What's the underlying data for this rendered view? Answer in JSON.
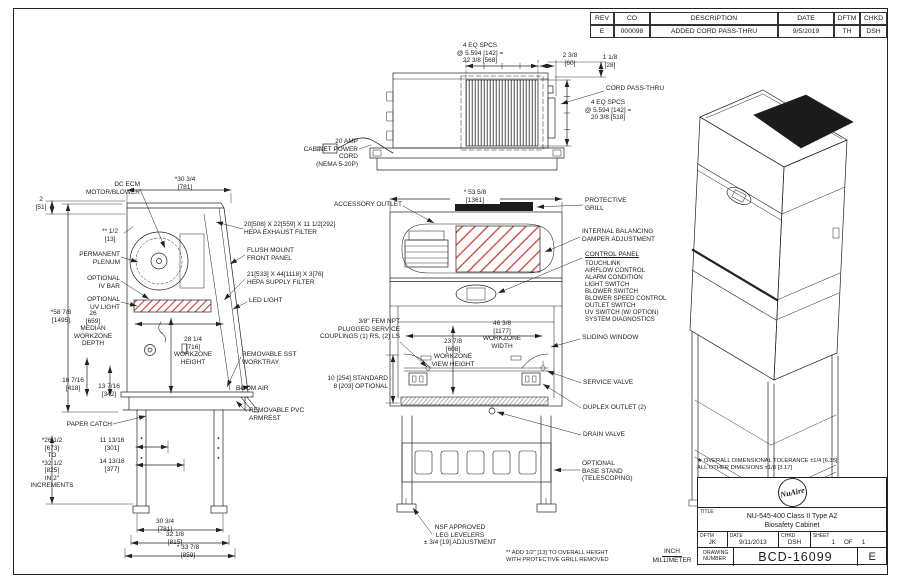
{
  "sheet": {
    "units_primary": "INCH",
    "units_secondary": "MILLIMETER",
    "tolerance_note": "★ OVERALL DIMENSIONAL TOLERANCE ±1/4 [6.35]\nALL OTHER DIMESIONS ±1/8 [3.17]",
    "footnote": "** ADD 1/2\" [13] TO OVERALL HEIGHT\nWITH PROTECTIVE GRILL REMOVED"
  },
  "revision_table": {
    "headers": [
      "REV",
      "CO",
      "DESCRIPTION",
      "DATE",
      "DFTM",
      "CHKD"
    ],
    "rows": [
      [
        "E",
        "000098",
        "ADDED CORD PASS-THRU",
        "9/5/2019",
        "TH",
        "DSH"
      ]
    ]
  },
  "title_block": {
    "logo": "NuAire",
    "title_label": "TITLE",
    "title": "NU-545-400 Class II Type A2\nBiosafety Cabinet",
    "dftm_label": "DFTM",
    "dftm": "JK",
    "date_label": "DATE",
    "date": "9/11/2013",
    "chkd_label": "CHKD",
    "chkd": "DSH",
    "sheet_label": "SHEET",
    "sheet_num": "1",
    "of_label": "OF",
    "sheet_total": "1",
    "drawing_number_label": "DRAWING\nNUMBER",
    "drawing_number": "BCD-16099",
    "revision": "E"
  },
  "colors": {
    "line": "#222222",
    "hatch_red": "#c94036",
    "grille_dark": "#1b1b1b"
  },
  "labels": {
    "dc_ecm": "DC ECM\nMOTOR/BLOWER",
    "dim_2": "2\n[51]",
    "dim_30_34_top": "*30 3/4\n[781]",
    "dim_half": "** 1/2\n[13]",
    "permanent_plenum": "PERMANENT\nPLENUM",
    "optional_iv_bar": "OPTIONAL\nIV BAR",
    "optional_uv_light": "OPTIONAL\nUV LIGHT",
    "dim_58_78": "*58 7/8\n[1495]",
    "median_workzone": "26\n[659]\nMEDIAN\nWORKZONE\nDEPTH",
    "workzone_height": "28 1/4\n[716]\nWORKZONE\nHEIGHT",
    "dim_16_716": "16 7/16\n[418]",
    "dim_13_716": "13 7/16\n[342]",
    "paper_catch": "PAPER CATCH",
    "stand_range": "*26 1/2\n[673]\nTO\n*32 1/2\n[825]\nIN 2\"\nINCREMENTS",
    "dim_11_1316": "11 13/16\n[301]",
    "dim_14_1316": "14 13/16\n[377]",
    "dim_30_34_bot": "30 3/4\n[781]",
    "dim_32_18": "32 1/8\n[815]",
    "dim_33_78": "* 33 7/8\n[859]",
    "hepa_exhaust": "20[508] X 22[559] X 11 1/2[292]\nHEPA EXHAUST FILTER",
    "flush_mount": "FLUSH MOUNT\nFRONT PANEL",
    "hepa_supply": "21[533] X 44[1118] X 3[76]\nHEPA SUPPLY FILTER",
    "led_light": "LED LIGHT",
    "service_couplings": "3/8\" FEM NPT\nPLUGGED SERVICE\nCOUPLINGS (1) RS, (2) LS",
    "removable_sst": "REMOVABLE SST\nWORKTRAY",
    "room_air": "ROOM AIR",
    "removable_pvc": "REMOVABLE PVC\nARMREST",
    "worktray_height": "10 [254] STANDARD\n8 [203] OPTIONAL",
    "eq_spcs_top": "4 EQ SPCS\n@ 5.594 [142] =\n22 3/8 [568]",
    "dim_2_38": "2 3/8\n[60]",
    "dim_1_18": "1 1/8\n[28]",
    "cord_pass_thru": "CORD PASS-THRU",
    "eq_spcs_side": "4 EQ SPCS\n@ 5.594 [142] =\n20 3/8 [518]",
    "power_cord": "20 AMP\nCABINET POWER CORD\n(NEMA 5-20P)",
    "accessory_outlet": "ACCESSORY OUTLET",
    "dim_53_58": "* 53 5/8\n[1361]",
    "protective_grill": "PROTECTIVE\nGRILL",
    "internal_balancing": "INTERNAL BALANCING\nDAMPER ADJUSTMENT",
    "control_panel_title": "CONTROL PANEL",
    "control_panel_items": [
      "TOUCHLINK",
      "AIRFLOW CONTROL",
      "ALARM CONDITION",
      "LIGHT SWITCH",
      "BLOWER SWITCH",
      "BLOWER SPEED CONTROL",
      "OUTLET SWITCH",
      "UV SWITCH (W/ OPTION)",
      "SYSTEM DIAGNOSTICS"
    ],
    "sliding_window": "SLIDING WINDOW",
    "workzone_width": "46 3/8\n[1177]\nWORKZONE\nWIDTH",
    "workzone_view_height": "23 7/8\n[608]\nWORKZONE\nVIEW HEIGHT",
    "service_valve": "SERVICE VALVE",
    "duplex_outlet": "DUPLEX OUTLET (2)",
    "drain_valve": "DRAIN VALVE",
    "base_stand": "OPTIONAL\nBASE STAND\n(TELESCOPING)",
    "nsf_levelers": "NSF APPROVED\nLEG LEVELERS\n± 3/4 [19] ADJUSTMENT"
  }
}
